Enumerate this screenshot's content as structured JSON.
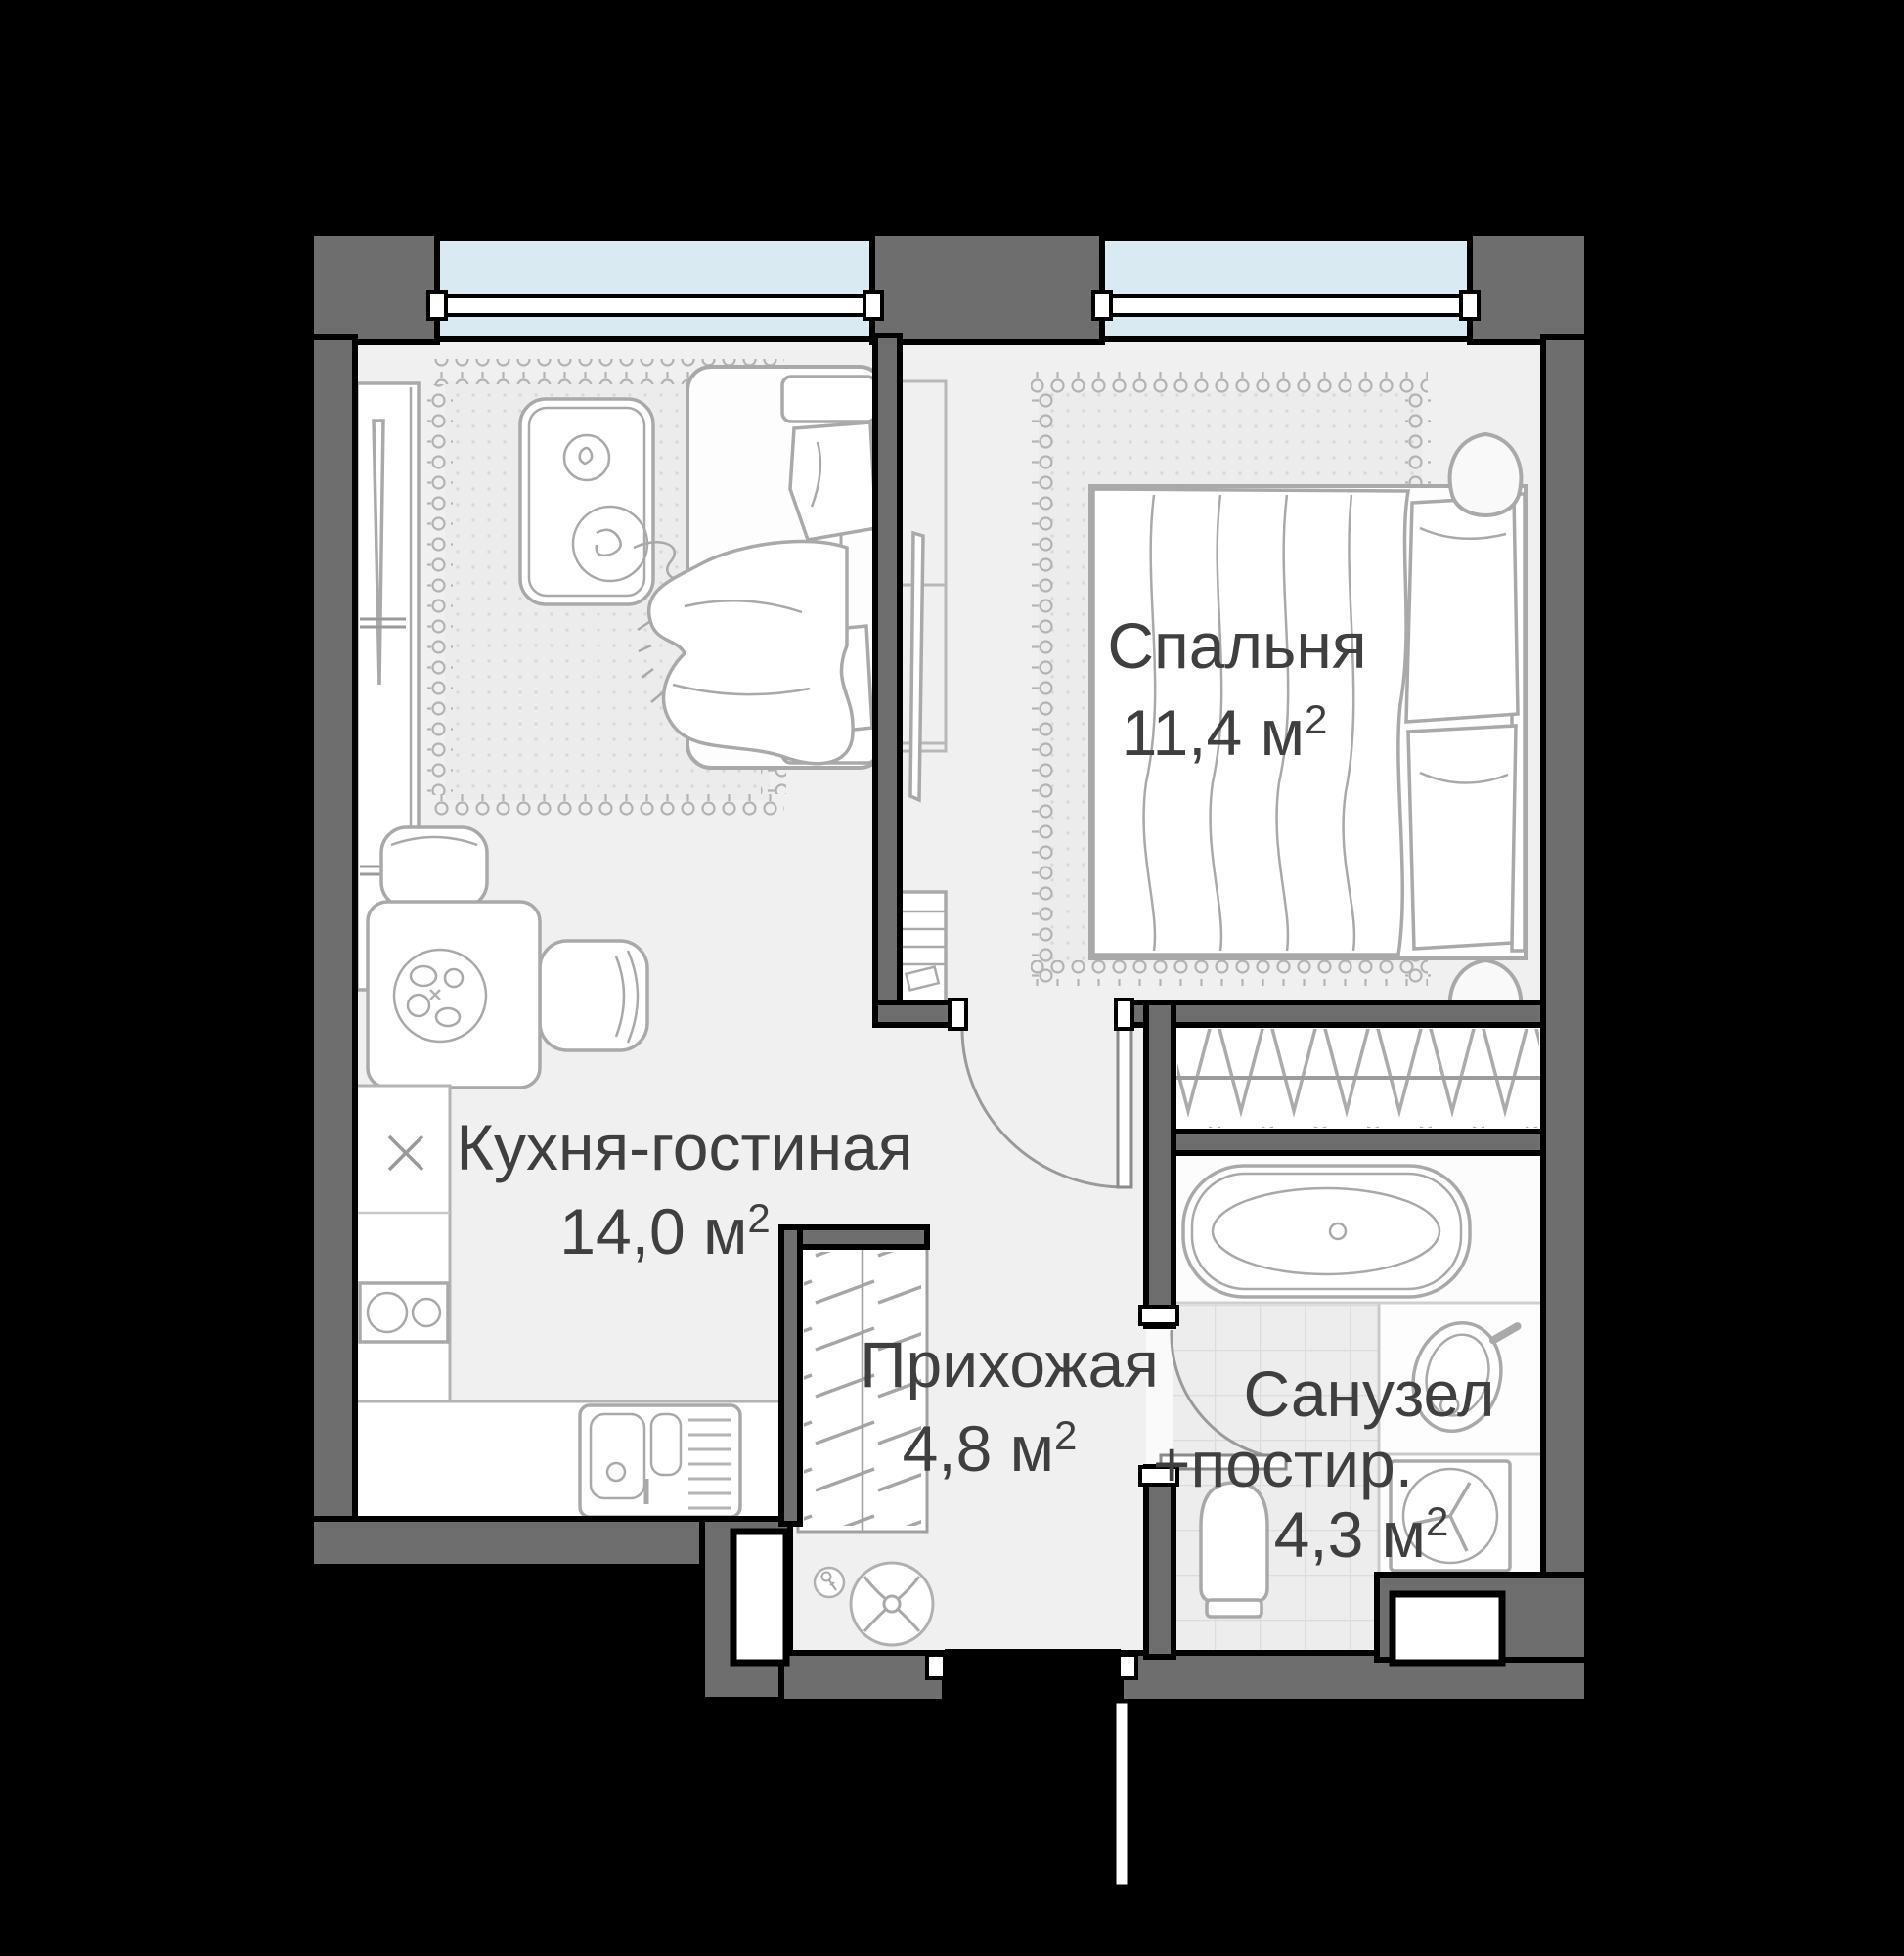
{
  "plan": {
    "type": "apartment-floor-plan",
    "language": "ru"
  },
  "rooms": {
    "bedroom": {
      "name": "Спальня",
      "area": "11,4 м",
      "sup": "2"
    },
    "living": {
      "name": "Кухня-гостиная",
      "area": "14,0 м",
      "sup": "2"
    },
    "hallway": {
      "name": "Прихожая",
      "area": "4,8 м",
      "sup": "2"
    },
    "bathroom": {
      "name_line1": "Санузел",
      "name_line2": "+постир.",
      "area": "4,3 м",
      "sup": "2"
    }
  },
  "colors": {
    "wall": "#6e6e6e",
    "glass": "#d9eaf3",
    "floor": "#f0f0f0",
    "floorLight": "#fafafa",
    "text": "#3f3f3f",
    "rug": "#ececec"
  }
}
